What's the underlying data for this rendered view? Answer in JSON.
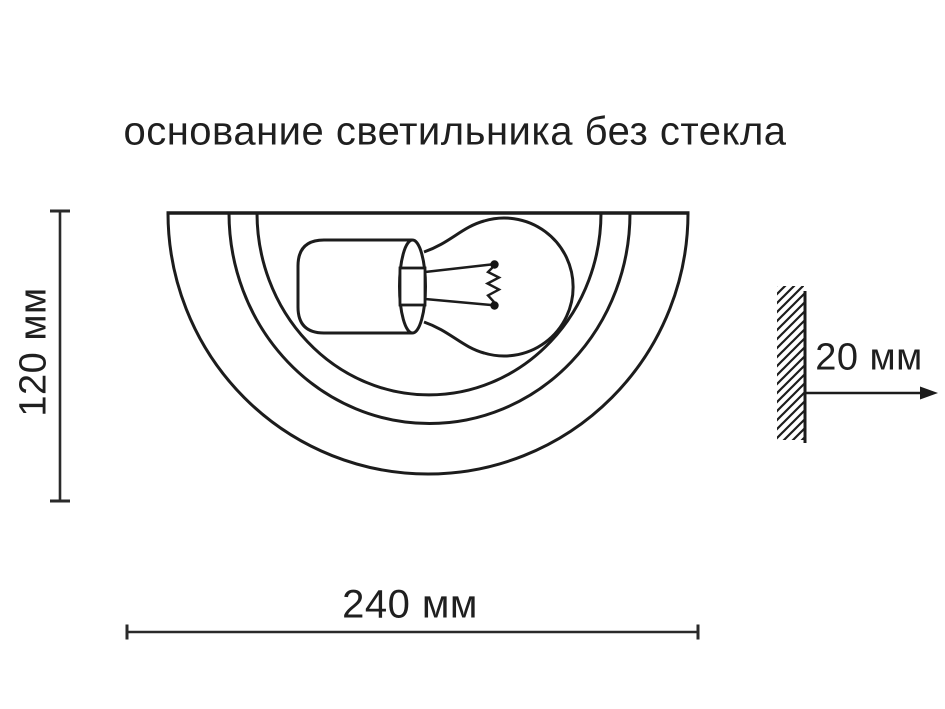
{
  "title": "основание светильника без стекла",
  "dimensions": {
    "height": {
      "label": "120 мм"
    },
    "width": {
      "label": "240 мм"
    },
    "wall_offset": {
      "label": "20 мм"
    }
  },
  "colors": {
    "ink": "#1c1c1c",
    "background": "#ffffff"
  }
}
